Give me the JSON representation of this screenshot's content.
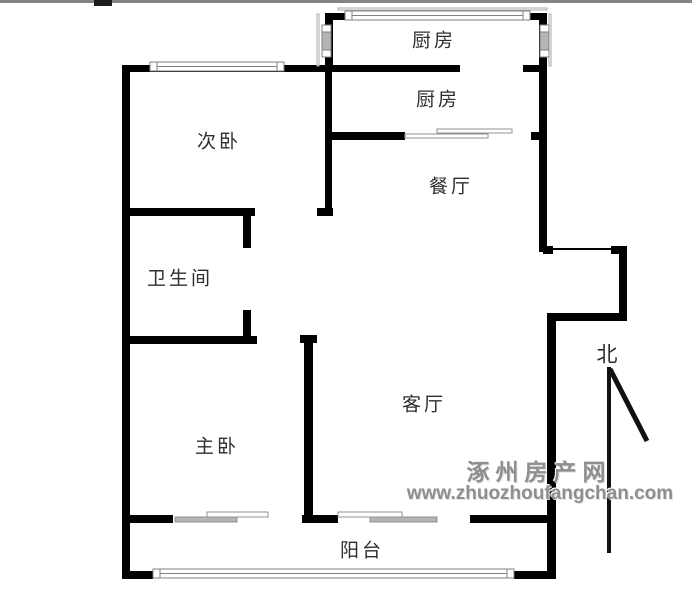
{
  "floorplan": {
    "labels": {
      "kitchen_balcony": "厨房",
      "kitchen": "厨房",
      "dining": "餐厅",
      "second_bedroom": "次卧",
      "bathroom": "卫生间",
      "living_room": "客厅",
      "master_bedroom": "主卧",
      "balcony": "阳台",
      "north": "北"
    },
    "watermark": {
      "site_name": "涿州房产网",
      "site_url": "www.zhuozhoufangchan.com"
    },
    "colors": {
      "wall": "#000000",
      "window_frame": "#808080",
      "window_glass": "#b5b5b5",
      "watermark_gray": "#8e8e8e",
      "top_border_gray": "#6e6e6e"
    }
  }
}
